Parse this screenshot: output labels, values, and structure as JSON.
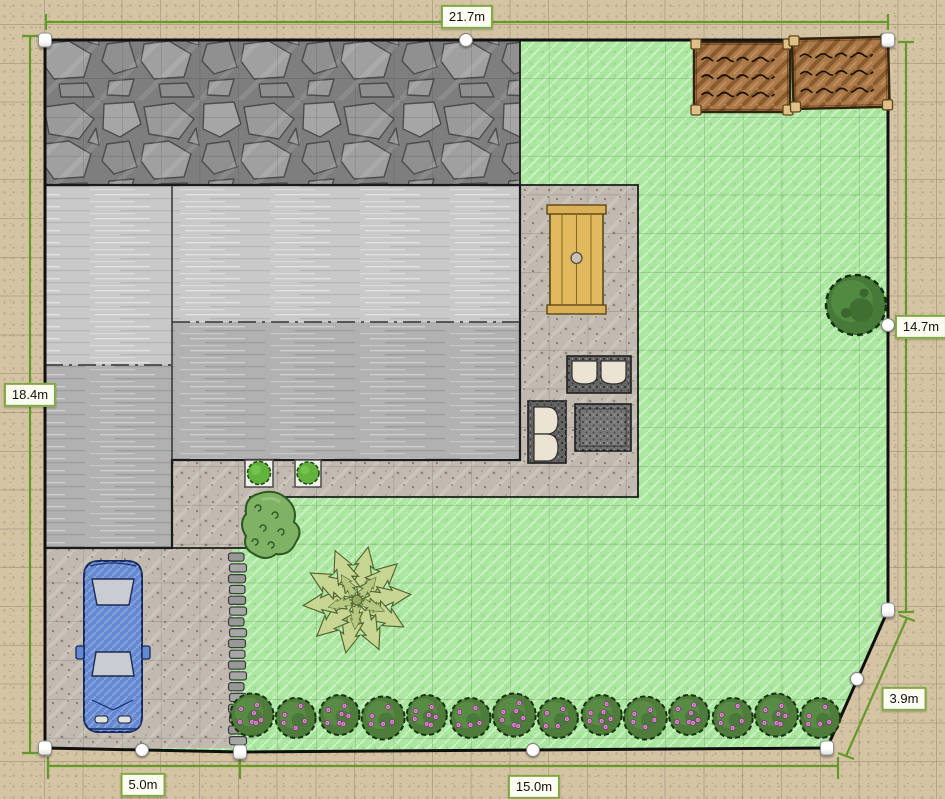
{
  "canvas": {
    "width": 945,
    "height": 799
  },
  "dimension_labels": {
    "top": "21.7m",
    "left": "18.4m",
    "right": "14.7m",
    "diagonal_right": "3.9m",
    "bottom_left": "5.0m",
    "bottom_center": "15.0m"
  },
  "colors": {
    "dimension_line": "#639b2a",
    "label_border": "#7fa83f",
    "lawn": "#a9e79e",
    "sand": "#d5c4a4",
    "plot_boundary": "#101010",
    "soil_bed": "#ad7b49",
    "wood_table": "#e2ba5e",
    "car_body": "#6488d2",
    "hedge_green": "#4e7d3b",
    "flower_pink": "#e292d6"
  },
  "scene": {
    "hedge": {
      "count": 14,
      "start_x": 252,
      "spacing": 43.7,
      "y": 716,
      "radius": 20
    },
    "stepping_stones": {
      "count": 18,
      "x": 228.5,
      "start_y": 553,
      "width": 17,
      "height": 8.2,
      "gap": 2.6
    },
    "palm": {
      "cx": 357,
      "cy": 600,
      "fronds": 10
    },
    "garden_beds": [
      {
        "x": 694,
        "y": 42,
        "w": 96,
        "h": 70,
        "rot": 0,
        "rows": 3
      },
      {
        "x": 792,
        "y": 39,
        "w": 96,
        "h": 70,
        "rot": -1.3,
        "rows": 3
      }
    ]
  }
}
